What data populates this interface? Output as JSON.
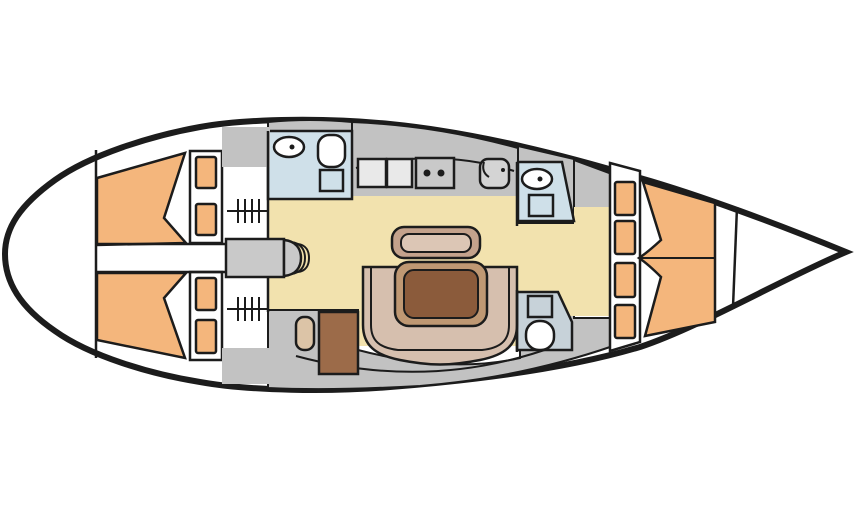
{
  "diagram": {
    "type": "sailing-yacht-interior-floor-plan",
    "orientation": "bow-pointing-right",
    "rooms": [
      {
        "name": "aft-cabin-port",
        "features": [
          "double-berth",
          "pillow-shelves",
          "hanging-locker",
          "stowage"
        ]
      },
      {
        "name": "aft-cabin-starboard",
        "features": [
          "double-berth",
          "pillow-shelves",
          "hanging-locker",
          "stowage"
        ]
      },
      {
        "name": "aft-head",
        "features": [
          "washbasin",
          "toilet",
          "shower"
        ]
      },
      {
        "name": "galley",
        "features": [
          "worktop-hatches",
          "two-burner-stove",
          "sink-with-faucet"
        ]
      },
      {
        "name": "saloon",
        "features": [
          "straight-settee",
          "u-shaped-settee",
          "dining-table"
        ]
      },
      {
        "name": "nav-station",
        "features": [
          "chart-table",
          "nav-seat"
        ]
      },
      {
        "name": "forward-head-shower",
        "features": [
          "washbasin",
          "shower"
        ]
      },
      {
        "name": "forward-head-toilet",
        "features": [
          "shower",
          "toilet"
        ]
      },
      {
        "name": "forward-cabin",
        "features": [
          "v-berth",
          "shelf-lockers"
        ]
      },
      {
        "name": "anchor-locker-bow",
        "features": []
      },
      {
        "name": "companionway",
        "features": [
          "steps"
        ]
      }
    ]
  },
  "colors": {
    "outline": "#1c1c1c",
    "hull-fill": "#ffffff",
    "deck": "#c2c2c2",
    "steps": "#c9c9c9",
    "cream": "#f2e2ae",
    "orange": "#f4b67c",
    "head-blue": "#cfe0e9",
    "head-blue2": "#c7d2d9",
    "fixture": "#ffffff",
    "galley-hatch": "#e9e9e9",
    "stove": "#c9c9c9",
    "sinkbox": "#d4d4d4",
    "settee": "#d6bfae",
    "bench-outer": "#c4a28c",
    "bench-inner": "#dcc6b5",
    "table-ring": "#bf9873",
    "table-top": "#8b5b3b",
    "desk": "#9c6b49",
    "seat": "#dcc4a7"
  }
}
